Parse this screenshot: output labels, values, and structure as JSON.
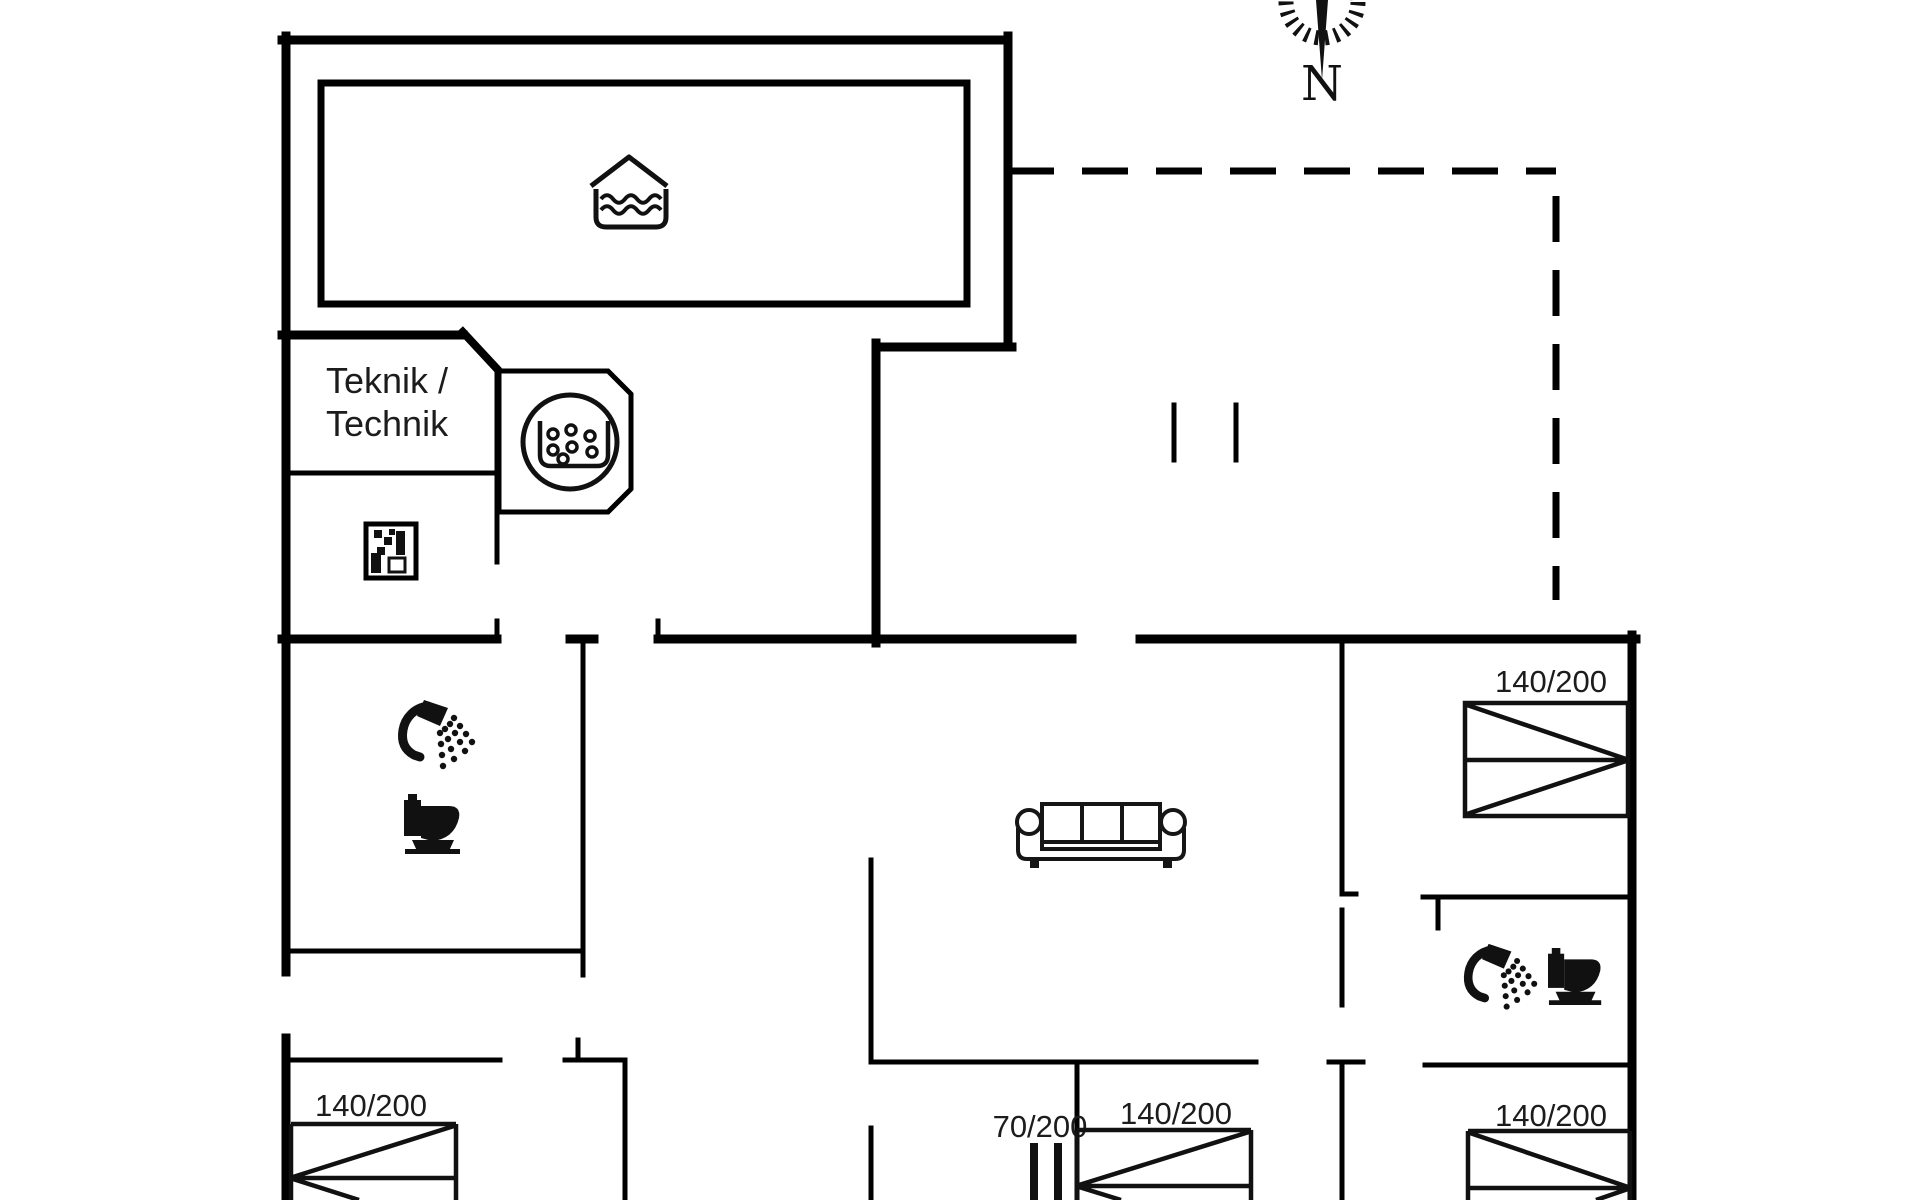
{
  "canvas": {
    "width": 1920,
    "height": 1200,
    "background": "#ffffff",
    "line_color": "#000000"
  },
  "compass": {
    "north_label": "N"
  },
  "labels": {
    "technik_room_line1": "Teknik /",
    "technik_room_line2": "Technik"
  },
  "beds": {
    "top_right_bedroom": "140/200",
    "bottom_left_bedroom": "140/200",
    "bottom_middle_single": "70/200",
    "bottom_middle_double": "140/200",
    "bottom_right_bedroom": "140/200"
  },
  "icons": {
    "pool": "covered-pool-icon",
    "hot_tub": "hot-tub-bubbles-icon",
    "washing_machine": "washing-machine-icon",
    "shower": "shower-icon",
    "toilet": "toilet-icon",
    "sofa": "sofa-icon",
    "compass": "compass-rose-icon"
  }
}
